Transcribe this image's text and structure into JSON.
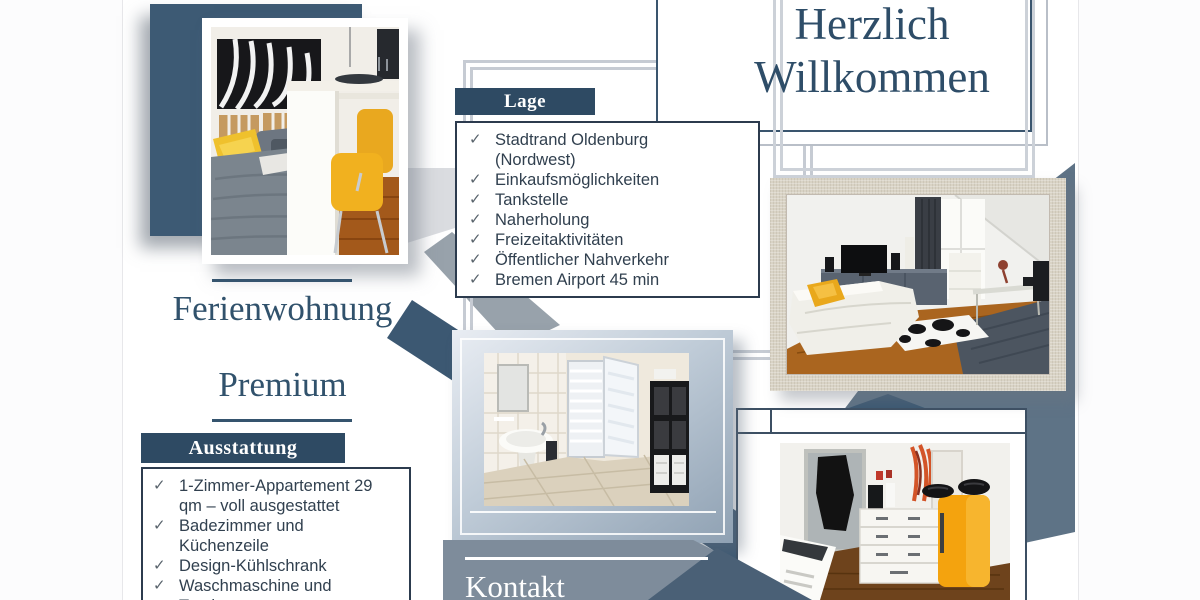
{
  "welcome": {
    "line1": "Herzlich",
    "line2": "Willkommen"
  },
  "brand": {
    "line1": "Ferienwohnung",
    "line2": "Premium"
  },
  "lage": {
    "label": "Lage",
    "items": [
      "Stadtrand Oldenburg (Nordwest)",
      "Einkaufsmöglichkeiten",
      "Tankstelle",
      "Naherholung",
      "Freizeitaktivitäten",
      "Öffentlicher Nahverkehr",
      "Bremen Airport 45 min"
    ]
  },
  "ausstattung": {
    "label": "Ausstattung",
    "items": [
      "1-Zimmer-Appartement 29 qm – voll ausgestattet",
      "Badezimmer und Küchenzeile",
      "Design-Kühlschrank",
      "Waschmaschine und Trockner"
    ]
  },
  "kontakt": {
    "label": "Kontakt"
  },
  "icons": {
    "check": "✓"
  },
  "colors": {
    "navy_text": "#2e4d68",
    "label_bg": "#2e4a63",
    "navy_square": "#3d5a74",
    "panel": "#7e8c9b",
    "panel_dark": "#4a6076",
    "blue_band": "#5e7386",
    "accent_yellow": "#efb01f",
    "wood": "#a85f1b",
    "linen_frame": "#d9d3c5"
  }
}
